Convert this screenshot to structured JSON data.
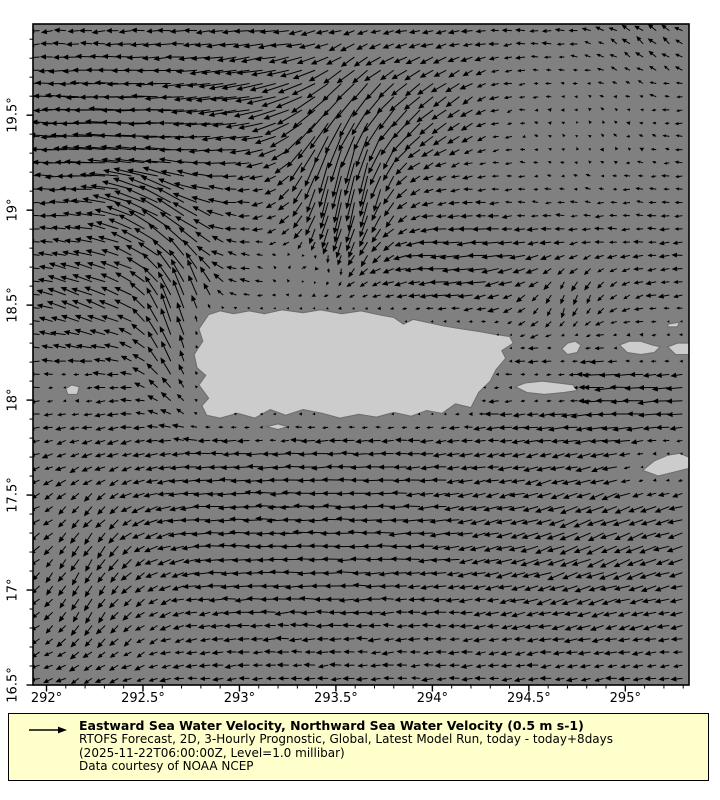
{
  "figure": {
    "background": "#ffffff"
  },
  "chart_data": {
    "type": "quiver",
    "description": "Sea water velocity vector field around Puerto Rico on a gray land-mask map",
    "colors": {
      "ocean": "#808080",
      "land": "#cccccc",
      "coast": "#6e6e6e",
      "frame": "#000000",
      "arrow": "#000000"
    },
    "x_axis": {
      "range": [
        291.93,
        295.33
      ],
      "tick_values": [
        292,
        292.5,
        293,
        293.5,
        294,
        294.5,
        295
      ],
      "tick_labels": [
        "292°",
        "292.5°",
        "293°",
        "293.5°",
        "294°",
        "294.5°",
        "295°"
      ],
      "minor_step": 0.1
    },
    "y_axis": {
      "range": [
        16.5,
        19.98
      ],
      "tick_values": [
        16.5,
        17,
        17.5,
        18,
        18.5,
        19,
        19.5
      ],
      "tick_labels": [
        "16.5°",
        "17°",
        "17.5°",
        "18°",
        "18.5°",
        "19°",
        "19.5°"
      ],
      "minor_step": 0.1
    },
    "grid": {
      "nx": 50,
      "ny": 50
    },
    "reference_vector": {
      "speed_ms": 0.5,
      "label": "0.5 m s-1",
      "px_per_ms": 40
    },
    "flow_field": {
      "base": {
        "u": -0.26,
        "v": -0.02
      },
      "noise": 0.08,
      "blobs": [
        [
          292.35,
          19.4,
          0.4,
          0.35,
          -0.55,
          0.05
        ],
        [
          293.15,
          19.6,
          0.45,
          0.3,
          -0.45,
          -0.1
        ],
        [
          292.62,
          18.98,
          0.25,
          0.22,
          -0.45,
          0.4
        ],
        [
          292.72,
          18.4,
          0.2,
          0.38,
          0.02,
          0.8
        ],
        [
          293.55,
          19.2,
          0.26,
          0.45,
          0.1,
          -0.85
        ],
        [
          293.95,
          19.55,
          0.35,
          0.28,
          -0.15,
          -0.3
        ],
        [
          294.8,
          19.4,
          0.55,
          0.4,
          0.22,
          0.06
        ],
        [
          295.15,
          19.9,
          0.3,
          0.2,
          0.05,
          0.18
        ],
        [
          293.35,
          18.7,
          0.22,
          0.14,
          0.35,
          0.18
        ],
        [
          294.25,
          18.72,
          0.35,
          0.18,
          -0.25,
          -0.02
        ],
        [
          292.25,
          18.55,
          0.28,
          0.3,
          -0.25,
          0.22
        ],
        [
          294.7,
          18.55,
          0.3,
          0.2,
          0.18,
          -0.22
        ],
        [
          294.9,
          18.05,
          0.45,
          0.22,
          -0.28,
          0.0
        ],
        [
          293.3,
          17.35,
          0.75,
          0.45,
          -0.28,
          0.02
        ],
        [
          292.25,
          17.1,
          0.4,
          0.55,
          0.1,
          -0.28
        ],
        [
          294.85,
          17.25,
          0.6,
          0.45,
          -0.18,
          -0.16
        ]
      ]
    },
    "islands": {
      "puerto_rico": [
        [
          292.84,
          18.45
        ],
        [
          292.9,
          18.47
        ],
        [
          292.97,
          18.455
        ],
        [
          293.05,
          18.47
        ],
        [
          293.13,
          18.455
        ],
        [
          293.22,
          18.475
        ],
        [
          293.33,
          18.46
        ],
        [
          293.42,
          18.475
        ],
        [
          293.53,
          18.455
        ],
        [
          293.63,
          18.47
        ],
        [
          293.72,
          18.45
        ],
        [
          293.8,
          18.435
        ],
        [
          293.85,
          18.4
        ],
        [
          293.9,
          18.425
        ],
        [
          293.97,
          18.41
        ],
        [
          294.06,
          18.39
        ],
        [
          294.15,
          18.375
        ],
        [
          294.25,
          18.36
        ],
        [
          294.33,
          18.345
        ],
        [
          294.4,
          18.335
        ],
        [
          294.42,
          18.3
        ],
        [
          294.36,
          18.26
        ],
        [
          294.38,
          18.22
        ],
        [
          294.33,
          18.16
        ],
        [
          294.3,
          18.1
        ],
        [
          294.24,
          18.04
        ],
        [
          294.2,
          17.96
        ],
        [
          294.12,
          17.98
        ],
        [
          294.05,
          17.93
        ],
        [
          293.97,
          17.945
        ],
        [
          293.89,
          17.915
        ],
        [
          293.8,
          17.935
        ],
        [
          293.71,
          17.91
        ],
        [
          293.62,
          17.925
        ],
        [
          293.52,
          17.905
        ],
        [
          293.43,
          17.93
        ],
        [
          293.33,
          17.95
        ],
        [
          293.24,
          17.92
        ],
        [
          293.16,
          17.95
        ],
        [
          293.08,
          17.905
        ],
        [
          292.99,
          17.93
        ],
        [
          292.9,
          17.905
        ],
        [
          292.83,
          17.92
        ],
        [
          292.805,
          17.97
        ],
        [
          292.84,
          18.01
        ],
        [
          292.79,
          18.08
        ],
        [
          292.825,
          18.13
        ],
        [
          292.78,
          18.17
        ],
        [
          292.765,
          18.24
        ],
        [
          292.81,
          18.31
        ],
        [
          292.79,
          18.375
        ]
      ],
      "vieques": [
        [
          294.43,
          18.07
        ],
        [
          294.48,
          18.09
        ],
        [
          294.57,
          18.1
        ],
        [
          294.65,
          18.09
        ],
        [
          294.73,
          18.08
        ],
        [
          294.75,
          18.05
        ],
        [
          294.68,
          18.04
        ],
        [
          294.58,
          18.03
        ],
        [
          294.49,
          18.04
        ]
      ],
      "culebra": [
        [
          294.67,
          18.27
        ],
        [
          294.7,
          18.3
        ],
        [
          294.74,
          18.31
        ],
        [
          294.77,
          18.29
        ],
        [
          294.75,
          18.25
        ],
        [
          294.7,
          18.24
        ]
      ],
      "st_thomas": [
        [
          294.97,
          18.29
        ],
        [
          295.02,
          18.31
        ],
        [
          295.08,
          18.31
        ],
        [
          295.14,
          18.29
        ],
        [
          295.18,
          18.28
        ],
        [
          295.15,
          18.25
        ],
        [
          295.08,
          18.24
        ],
        [
          295.01,
          18.25
        ]
      ],
      "island_right_edge": [
        [
          295.22,
          18.28
        ],
        [
          295.27,
          18.3
        ],
        [
          295.33,
          18.3
        ],
        [
          295.33,
          18.24
        ],
        [
          295.26,
          18.24
        ]
      ],
      "islets_right_edge": [
        [
          295.22,
          18.4
        ],
        [
          295.28,
          18.41
        ],
        [
          295.27,
          18.385
        ],
        [
          295.22,
          18.385
        ]
      ],
      "st_croix": [
        [
          295.09,
          17.63
        ],
        [
          295.15,
          17.68
        ],
        [
          295.22,
          17.71
        ],
        [
          295.28,
          17.72
        ],
        [
          295.33,
          17.7
        ],
        [
          295.33,
          17.64
        ],
        [
          295.25,
          17.62
        ],
        [
          295.17,
          17.6
        ]
      ],
      "mona": [
        [
          292.1,
          18.06
        ],
        [
          292.13,
          18.08
        ],
        [
          292.17,
          18.07
        ],
        [
          292.16,
          18.03
        ],
        [
          292.11,
          18.03
        ]
      ],
      "caja_de_muertos": [
        [
          293.14,
          17.86
        ],
        [
          293.2,
          17.875
        ],
        [
          293.25,
          17.86
        ],
        [
          293.2,
          17.845
        ]
      ]
    }
  },
  "legend": {
    "bg_color": "#ffffcc",
    "border_color": "#000000",
    "arrow_icon": "reference-vector-arrow",
    "title": "Eastward Sea Water Velocity, Northward Sea Water Velocity (0.5 m s-1)",
    "subtitle1": "RTOFS Forecast, 2D, 3-Hourly Prognostic, Global, Latest Model Run, today - today+8days",
    "subtitle2": "(2025-11-22T06:00:00Z, Level=1.0 millibar)",
    "credit": "Data courtesy of NOAA NCEP"
  }
}
